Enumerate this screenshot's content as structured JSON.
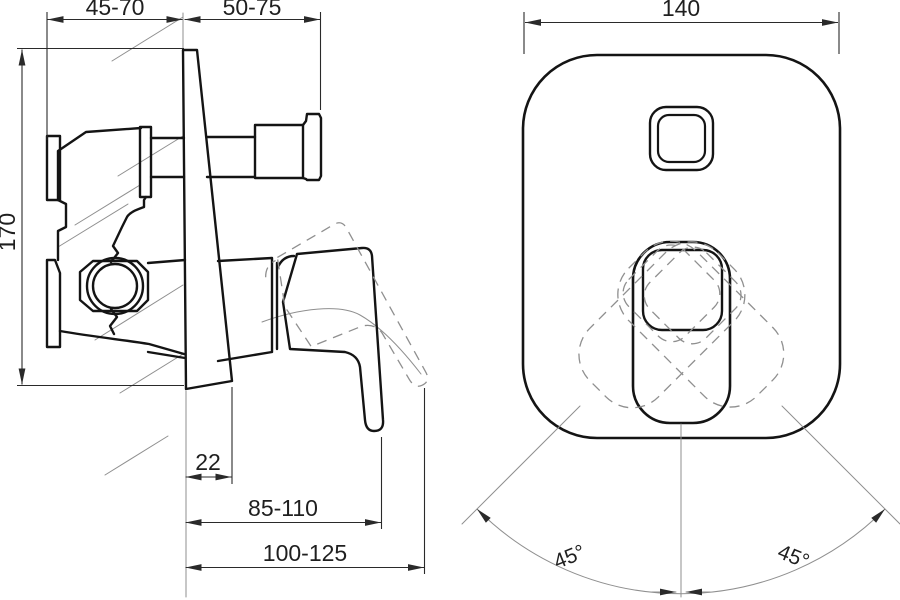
{
  "side_view": {
    "dimensions": {
      "flange_to_wall": "45-70",
      "wall_to_outlet": "50-75",
      "height": "170",
      "plate_bottom_depth": "22",
      "lever_depth": "85-110",
      "lever_max_depth": "100-125"
    }
  },
  "front_view": {
    "dimensions": {
      "plate_width": "140",
      "lever_swing_left": "45°",
      "lever_swing_right": "45°"
    }
  },
  "colors": {
    "background": "#ffffff",
    "outline": "#141414",
    "dimension": "#2a2a2a",
    "construction": "#8f8f8f"
  }
}
